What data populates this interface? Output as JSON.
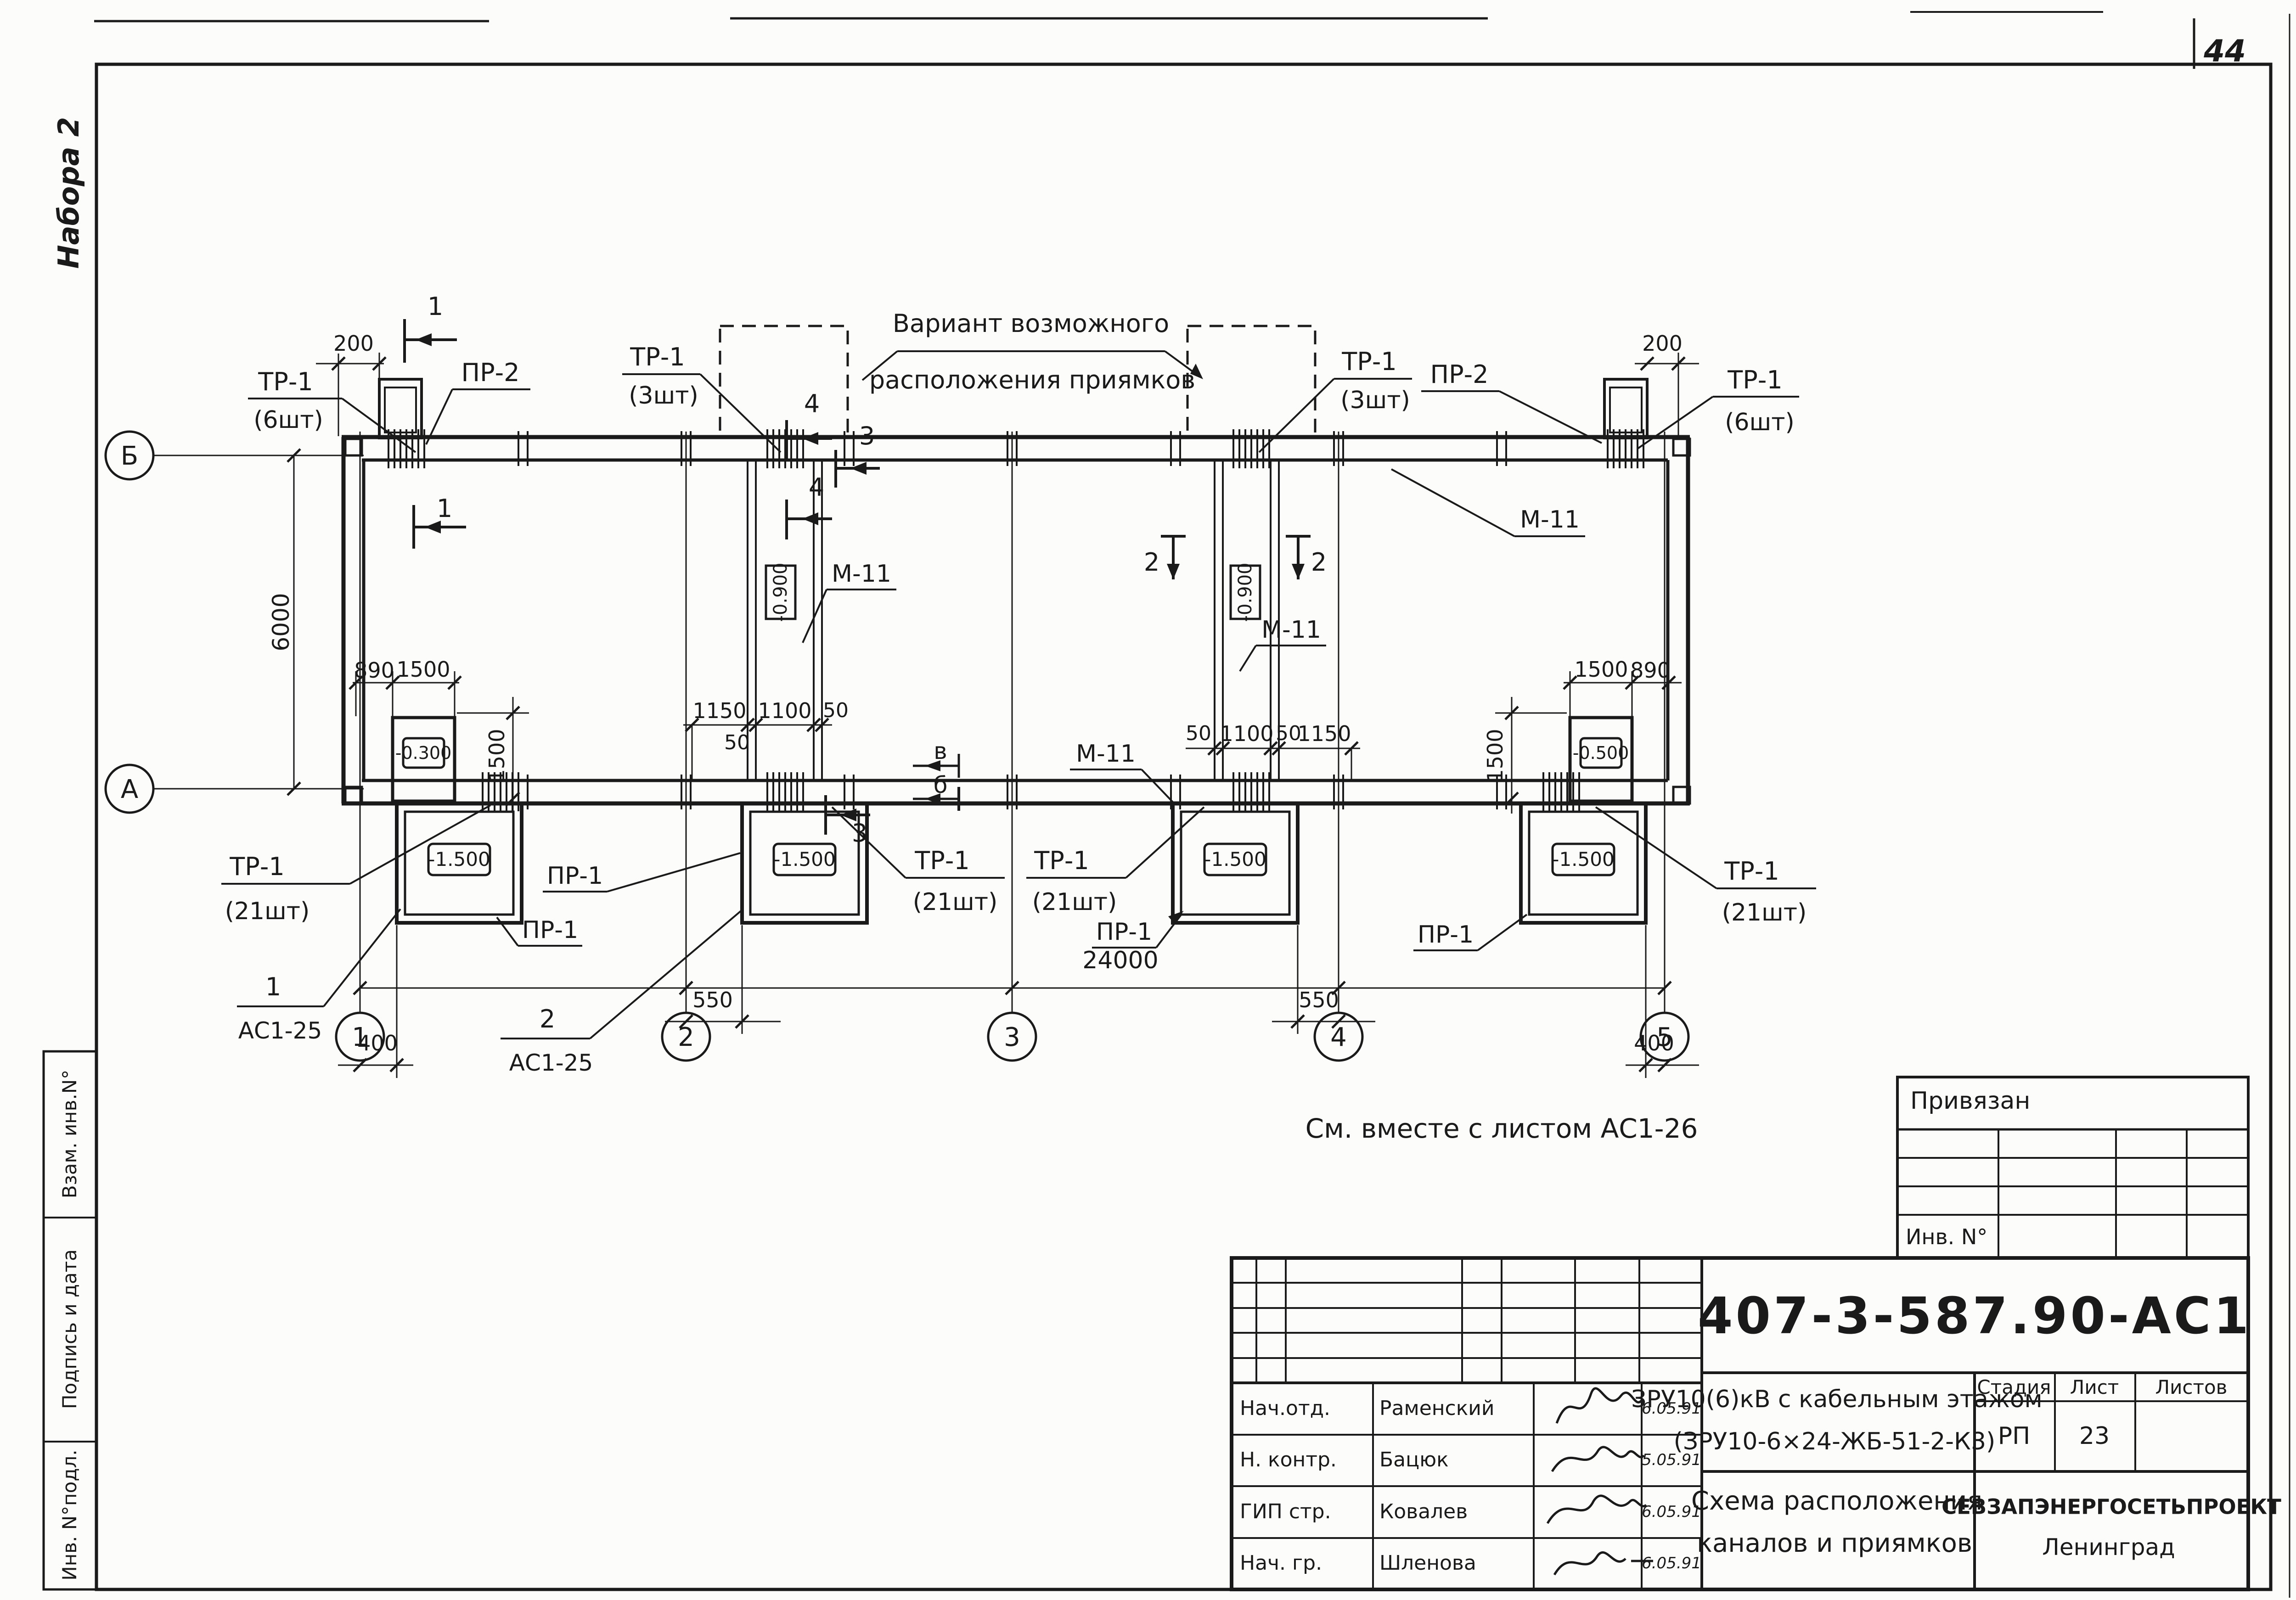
{
  "sheet": {
    "page_number": "44",
    "corner_stamp": "Набора 2"
  },
  "frame": {
    "side_labels": [
      "Взам. инв.N°",
      "Подпись и дата",
      "Инв. N°подл."
    ]
  },
  "plan": {
    "variant_note": {
      "line1": "Вариант возможного",
      "line2": "расположения приямков"
    },
    "see_note": "См. вместе с листом  АС1-26",
    "axis_numbers": [
      "1",
      "2",
      "3",
      "4",
      "5"
    ],
    "axis_letters": {
      "top": "Б",
      "bottom": "А"
    },
    "labels": {
      "tr1": "ТР-1",
      "qty6": "(6шт)",
      "qty3": "(3шт)",
      "qty21": "(21шт)",
      "pr2": "ПР-2",
      "pr1": "ПР-1",
      "m11": "М-11",
      "as1_25": "АС1-25",
      "detail1": "1",
      "detail2": "2"
    },
    "elevations": {
      "e0300": "-0.300",
      "e0500": "-0.500",
      "e0900": "-0.900",
      "e1500": "-1.500"
    },
    "dims": {
      "d200": "200",
      "d890": "890",
      "d1500": "1500",
      "d1150": "1150",
      "d1100": "1100",
      "d50": "50",
      "d400": "400",
      "d550": "550",
      "d6000": "6000",
      "d24000": "24000"
    },
    "section_marks": {
      "s1": "1",
      "s2": "2",
      "s3": "3",
      "s4": "4",
      "sv": "в",
      "sb": "б"
    }
  },
  "title_block": {
    "attachment": {
      "title": "Привязан",
      "inv_label": "Инв. N°"
    },
    "doc_number": "407-3-587.90-АС1",
    "object_line1": "ЗРУ10(6)кВ с кабельным этажом",
    "object_line2": "(ЗРУ10-6×24-ЖБ-51-2-К3)",
    "sheet_title_line1": "Схема расположения",
    "sheet_title_line2": "каналов и приямков",
    "org_line1": "СЕВЗАПЭНЕРГОСЕТЬПРОЕКТ",
    "org_line2": "Ленинград",
    "stage_header": "Стадия",
    "sheet_header": "Лист",
    "sheets_header": "Листов",
    "stage_value": "РП",
    "sheet_value": "23",
    "signatories": [
      {
        "role": "Нач.отд.",
        "name": "Раменский",
        "date": "6.05.91"
      },
      {
        "role": "Н. контр.",
        "name": "Бацюк",
        "date": "5.05.91"
      },
      {
        "role": "ГИП стр.",
        "name": "Ковалев",
        "date": "6.05.91"
      },
      {
        "role": "Нач. гр.",
        "name": "Шленова",
        "date": "6.05.91"
      }
    ]
  }
}
